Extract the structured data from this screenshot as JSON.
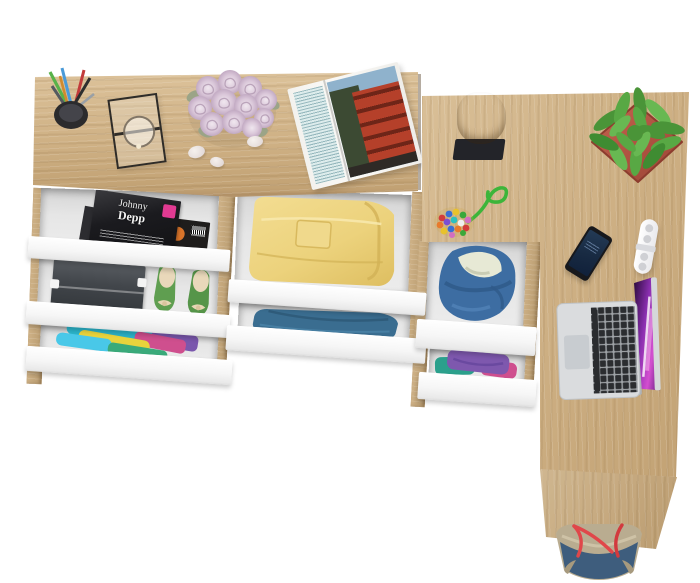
{
  "scene": {
    "description": "Overhead product render of a light oak desk and chest of drawers combination with open white drawers revealing magazines, shoes and folded clothes; an L-shaped return desk holds a laptop, phone and plant",
    "background_color": "#ffffff"
  },
  "palette": {
    "oak": "#d0b386",
    "oak_dark": "#b4976b",
    "drawer_front_white": "#f7f7f7",
    "drawer_interior_gray": "#e2e2e2",
    "plant_pot_red": "#b85746",
    "plant_green": "#55a243",
    "denim_blue": "#3d6da2",
    "sweater_yellow": "#eed47f",
    "shirt_blue": "#3a6d90",
    "shoe_green": "#5f9e50",
    "bag_denim": "#3e5d7d",
    "bag_handle_red": "#e0474a",
    "laptop_silver": "#d8dadc",
    "laptop_screen_purple": "#b13bd0"
  },
  "magazine_cover": {
    "title_line1": "Johnny",
    "title_line2": "Depp",
    "badge_color": "#e13a92"
  },
  "furniture": {
    "left_unit": {
      "label": "desk with drawer chest",
      "drawers": [
        {
          "contents": "magazines"
        },
        {
          "contents": "shoe box and green ballet flats"
        },
        {
          "contents": "colorful folded clothes"
        }
      ]
    },
    "middle_column_drawers": [
      {
        "contents": "folded yellow sweater"
      },
      {
        "contents": "folded blue denim shirt"
      }
    ],
    "right_unit": {
      "label": "L-shaped return desk",
      "drawers": [
        {
          "contents": "denim jacket with fleece lining"
        },
        {
          "contents": "purple and teal folded clothes"
        }
      ]
    }
  },
  "desk_items": [
    {
      "name": "pen-cup",
      "label": "black cup with pens and pencils"
    },
    {
      "name": "glass-lantern",
      "label": "black framed glass candle lantern"
    },
    {
      "name": "rose-bouquet",
      "label": "pale pink roses"
    },
    {
      "name": "pebbles",
      "label": "three white decorative stones"
    },
    {
      "name": "open-magazine",
      "label": "open magazine with red bus photo"
    },
    {
      "name": "wood-stump",
      "label": "wooden stump sculpture on black base"
    },
    {
      "name": "bead-keychain",
      "label": "multicolored bead charm with green cord"
    },
    {
      "name": "potted-plant",
      "label": "green succulent in square terracotta pot"
    },
    {
      "name": "smartphone",
      "label": "black smartphone"
    },
    {
      "name": "cable-clip",
      "label": "white cable organizer"
    },
    {
      "name": "laptop",
      "label": "silver open laptop with purple wallpaper"
    },
    {
      "name": "tote-bag",
      "label": "denim tote bag with red rope handles"
    }
  ]
}
